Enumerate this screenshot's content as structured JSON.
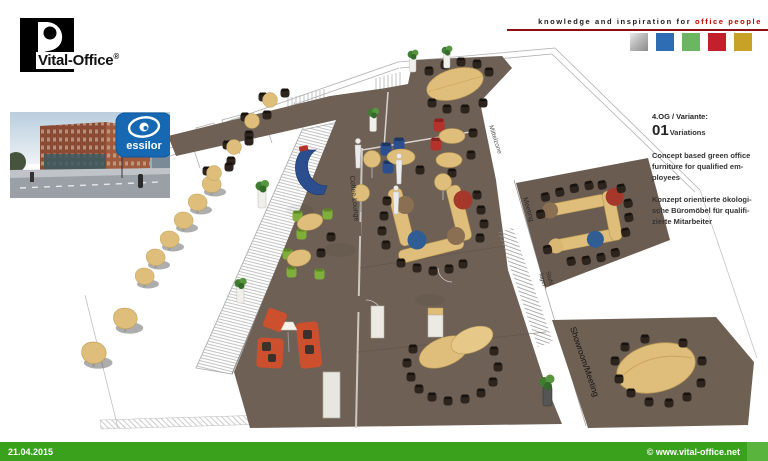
{
  "brand": {
    "logo_text": "Vital-Office",
    "registered_mark": "®",
    "tagline_black": "knowledge and inspiration for",
    "tagline_red": "office people",
    "colors": {
      "divider_red": "#8f1010",
      "square_silver": "#b9b9b9",
      "square_blue": "#2e6db4",
      "square_green": "#6ab661",
      "square_red": "#c2202a",
      "square_gold": "#c8a127"
    }
  },
  "client_logo": {
    "name": "essilor",
    "background": "#1668b3"
  },
  "info_panel": {
    "variant_label": "4.OG / Variante:",
    "variant_number": "01",
    "variant_suffix": "Variations",
    "description_en": "Concept based green office\nfurniture for qualified em-\nployees",
    "description_de": "Konzept orientierte ökologi-\nsche Büromöbel für qualifi-\nzierte Mitarbeiter"
  },
  "floorplan": {
    "labels": {
      "coffee_lounge": "Coffee Lounge",
      "mittelzone": "Mittelzone",
      "meeting": "Meeting",
      "stuhl_line1": "Stuhl",
      "stuhl_line2": "lager",
      "showroom_meeting": "Showroom/Meeting"
    },
    "colors": {
      "floor_brown": "#6e6055",
      "table_wood": "#dfbd7a",
      "accent_orange": "#cc4f2e",
      "accent_green": "#7fae3a",
      "accent_blue": "#2b4f8e",
      "accent_red": "#b3322b"
    }
  },
  "footer": {
    "date": "21.04.2015",
    "copyright": "© www.vital-office.net",
    "bar_color": "#3aa11c"
  }
}
